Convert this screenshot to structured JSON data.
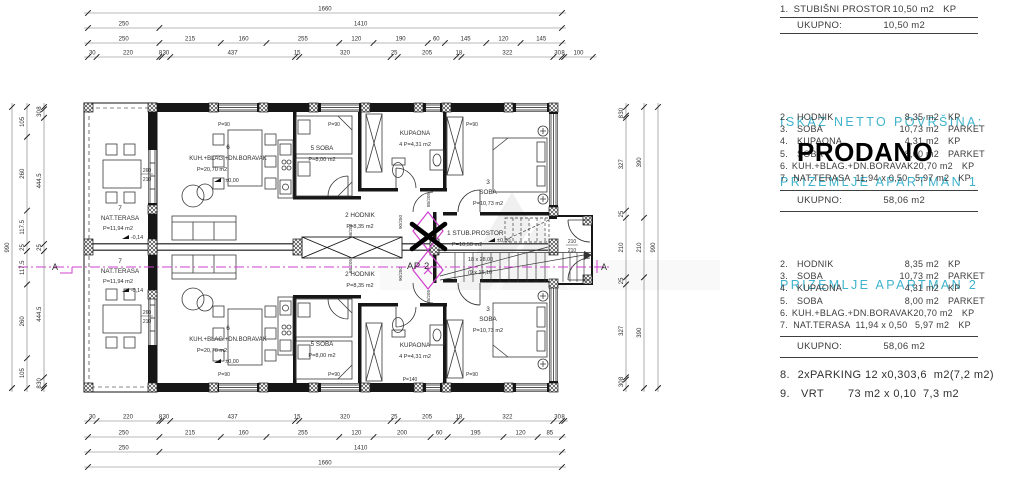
{
  "panel": {
    "top_section": {
      "row": {
        "num": "1.",
        "name": "STUBIŠNI PROSTOR",
        "area": "10,50 m2",
        "type": "KP"
      },
      "ukupno_label": "UKUPNO:",
      "ukupno_value": "10,50 m2"
    },
    "heading_line1": "ISKAZ NETTO POVRŠINA:",
    "heading_line2": "PRIZEMLJE APARTMAN 1",
    "heading2": "PRIZEMLJE APARTMAN 2",
    "prodano": "PRODANO",
    "ukupno_label": "UKUPNO:",
    "apartman1_total": "58,06 m2",
    "apartman2_total": "58,06 m2",
    "apartman1_items": [
      {
        "num": "2.",
        "name": "HODNIK",
        "area": "8,35 m2",
        "type": "KP"
      },
      {
        "num": "3.",
        "name": "SOBA",
        "area": "10,73 m2",
        "type": "PARKET"
      },
      {
        "num": "4.",
        "name": "KUPAONA",
        "area": "4,31 m2",
        "type": "KP"
      },
      {
        "num": "5.",
        "name": "SOBA",
        "area": "8,00 m2",
        "type": "PARKET"
      },
      {
        "num": "6.",
        "name": "KUH.+BLAG.+DN.BORAVAK",
        "area": "20,70 m2",
        "type": "KP"
      },
      {
        "num": "7.",
        "name": "NAT.TERASA  11,94 x 0,50",
        "area": "5,97 m2",
        "type": "KP"
      }
    ],
    "apartman2_items": [
      {
        "num": "2.",
        "name": "HODNIK",
        "area": "8,35 m2",
        "type": "KP"
      },
      {
        "num": "3.",
        "name": "SOBA",
        "area": "10,73 m2",
        "type": "PARKET"
      },
      {
        "num": "4.",
        "name": "KUPAONA",
        "area": "4,31 m2",
        "type": "KP"
      },
      {
        "num": "5.",
        "name": "SOBA",
        "area": "8,00 m2",
        "type": "PARKET"
      },
      {
        "num": "6.",
        "name": "KUH.+BLAG.+DN.BORAVAK",
        "area": "20,70 m2",
        "type": "KP"
      },
      {
        "num": "7.",
        "name": "NAT.TERASA  11,94 x 0,50",
        "area": "5,97 m2",
        "type": "KP"
      }
    ],
    "extras": [
      {
        "num": "8.",
        "desc": "2xPARKING 12 x0,30",
        "value": "3,6  m2(7,2 m2)"
      },
      {
        "num": "9.",
        "desc": "VRT       73 m2 x 0,10",
        "value": "7,3 m2"
      }
    ]
  },
  "plan": {
    "rooms": {
      "r1a": "1 STUB.PROSTOR",
      "r1b": "P=10,50 m2",
      "r2a": "2 HODNIK",
      "r2b": "P=8,35 m2",
      "r3a": "3",
      "r3b": "SOBA",
      "r3c": "P=10,73 m2",
      "r4a": "KUPAONA",
      "r4b": "4  P=4,31 m2",
      "r5a": "5 SOBA",
      "r5b": "P=8,00 m2",
      "r6a": "6",
      "r6b": "KUH.+BLAG.+DN.BORAVAK",
      "r6c": "P=20,70 m2",
      "r7a": "7",
      "r7b": "NAT.TERASA",
      "r7c": "P=11,94 m2"
    },
    "markers": {
      "level0": "±0,00",
      "levelT": "-0,14",
      "ap2": "AP 2",
      "a": "A",
      "stairs1": "18 x 28,00",
      "stairs2": "(9 x 15,10",
      "d260": "260",
      "d210": "210",
      "p90": "P=90",
      "p140": "P=140",
      "w85": "85/205",
      "w90": "90/250",
      "w68": "68/205"
    },
    "dims": {
      "top": [
        [
          "1660"
        ],
        [
          "250",
          "1410"
        ],
        [
          "250",
          "215",
          "160",
          "255",
          "120",
          "190",
          "60",
          "145",
          "120",
          "145"
        ],
        [
          "30",
          "220",
          "8",
          "30",
          "437",
          "15",
          "320",
          "25",
          "205",
          "18",
          "322",
          "30",
          "8",
          "100"
        ]
      ],
      "bottom": [
        [
          "30",
          "220",
          "8",
          "30",
          "437",
          "15",
          "320",
          "25",
          "205",
          "18",
          "322",
          "30",
          "8"
        ],
        [
          "250",
          "215",
          "160",
          "255",
          "120",
          "200",
          "60",
          "195",
          "120",
          "85"
        ],
        [
          "250",
          "1410"
        ],
        [
          "1660"
        ]
      ],
      "left": [
        [
          "990"
        ],
        [
          "105",
          "260",
          "117.5",
          "25",
          "117.5",
          "260",
          "105"
        ],
        [
          "8",
          "30",
          "444.5",
          "25",
          "444.5",
          "30",
          "8"
        ]
      ],
      "right": [
        [
          "30",
          "8",
          "327",
          "25",
          "210",
          "25",
          "327",
          "8",
          "30"
        ],
        [
          "390",
          "210",
          "390"
        ],
        [
          "990"
        ]
      ]
    }
  },
  "colors": {
    "cyan": "#3eb3cb",
    "magenta": "#cf3fcf",
    "line": "#161616"
  }
}
